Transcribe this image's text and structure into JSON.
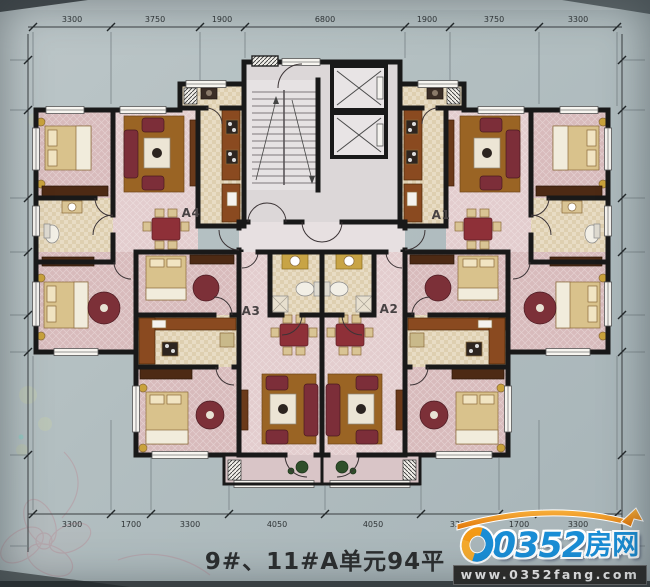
{
  "caption": "9#、11#A单元94平",
  "units": {
    "a1": "A1",
    "a2": "A2",
    "a3": "A3",
    "a4": "A4"
  },
  "dims": {
    "top": [
      "3300",
      "3750",
      "1900",
      "6800",
      "1900",
      "3750",
      "3300"
    ],
    "bottom": [
      "3300",
      "1700",
      "3300",
      "4050",
      "4050",
      "3300",
      "1700",
      "3300"
    ]
  },
  "logo": {
    "number": "0352",
    "suffix": "房网",
    "website": "www.0352fang.com"
  },
  "colors": {
    "logo_blue": "#1a8ed6",
    "logo_orange": "#f49a16",
    "wall": "#191919",
    "room_pink": "#d8bbbc",
    "floor_wood": "#9a6424",
    "sofa_red": "#7c2e39"
  }
}
